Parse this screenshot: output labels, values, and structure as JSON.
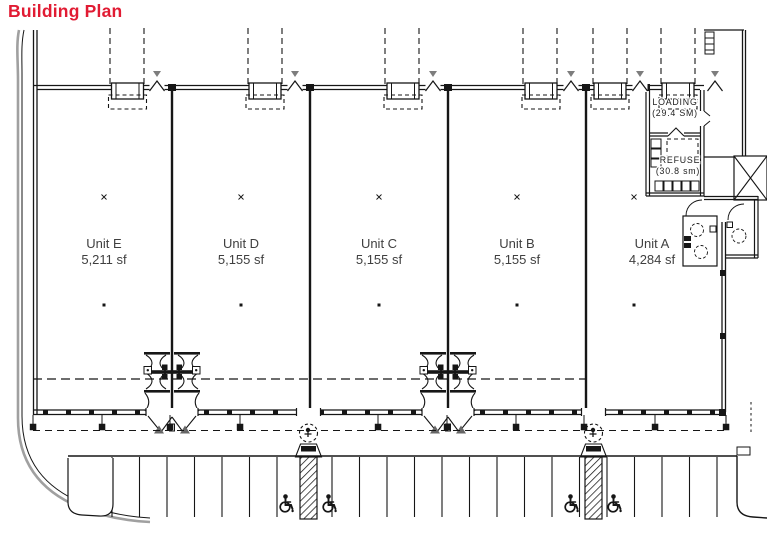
{
  "title": "Building Plan",
  "units": [
    {
      "name": "Unit E",
      "area": "5,211 sf"
    },
    {
      "name": "Unit D",
      "area": "5,155 sf"
    },
    {
      "name": "Unit C",
      "area": "5,155 sf"
    },
    {
      "name": "Unit B",
      "area": "5,155 sf"
    },
    {
      "name": "Unit A",
      "area": "4,284 sf"
    }
  ],
  "service_rooms": {
    "loading": {
      "name": "LOADING",
      "area": "(29.4 SM)"
    },
    "refuse": {
      "name": "REFUSE",
      "area": "(30.8 sm)"
    }
  },
  "colors": {
    "title_red": "#e11b33",
    "line": "#161616",
    "road_grey": "#a0a0a0",
    "label_grey": "#3f3f3f"
  },
  "icons": {
    "accessible_parking_icon": "wheelchair",
    "door_swing_icon": "caret",
    "ramp_icon": "trapezoid-with-band"
  }
}
